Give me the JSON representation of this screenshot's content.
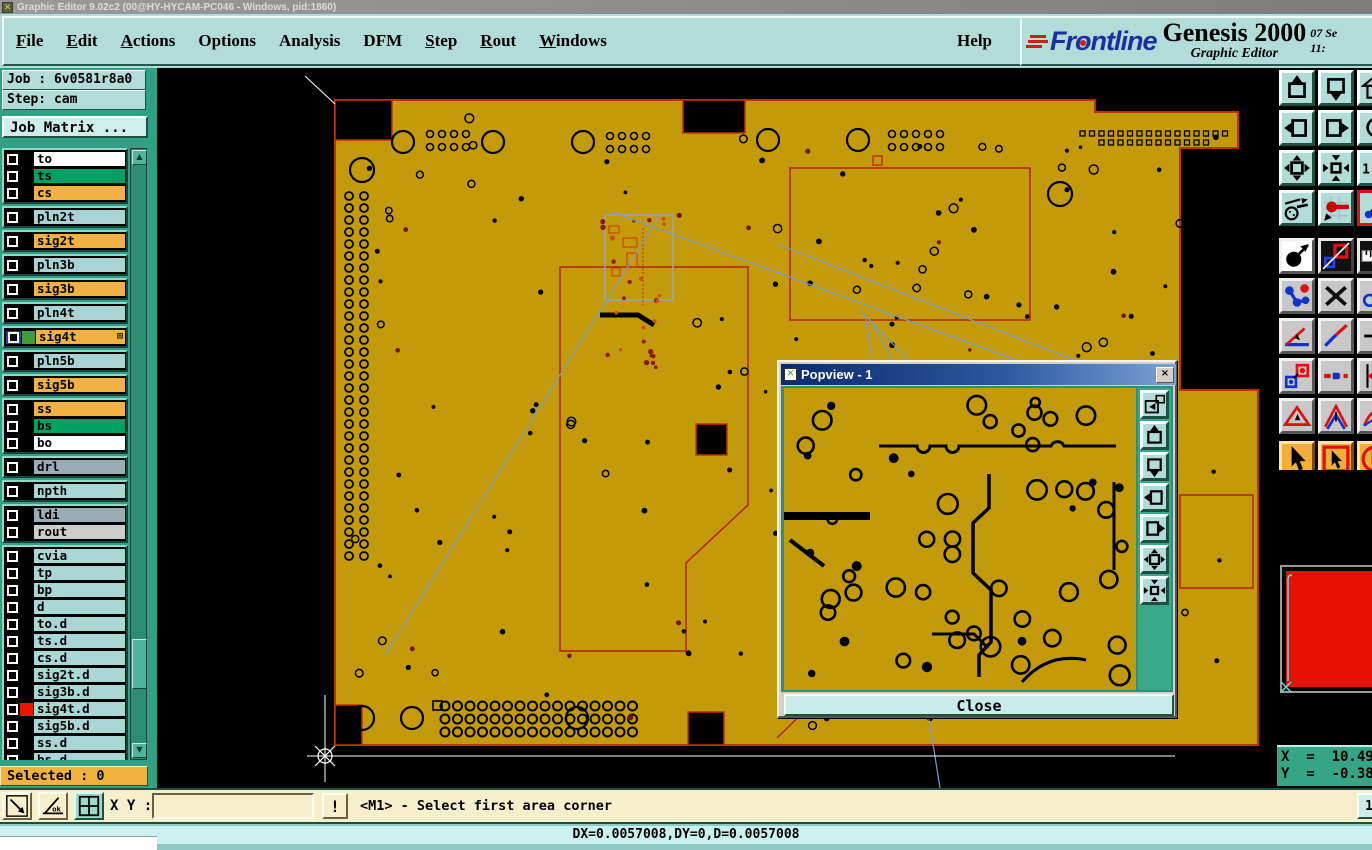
{
  "window": {
    "title": "Graphic Editor 9.02c2 (00@HY-HYCAM-PC046 - Windows, pid:1860)"
  },
  "menubar": {
    "items": [
      {
        "label": "File",
        "u": 0
      },
      {
        "label": "Edit",
        "u": 0
      },
      {
        "label": "Actions",
        "u": 0
      },
      {
        "label": "Options",
        "u": -1
      },
      {
        "label": "Analysis",
        "u": -1
      },
      {
        "label": "DFM",
        "u": -1
      },
      {
        "label": "Step",
        "u": 0
      },
      {
        "label": "Rout",
        "u": 0
      },
      {
        "label": "Windows",
        "u": 0
      }
    ],
    "help": {
      "label": "Help",
      "u": -1
    }
  },
  "brand": {
    "logo_text": "Frontline",
    "product": "Genesis 2000",
    "subtitle": "Graphic Editor",
    "date": "07 Se",
    "time": "11:"
  },
  "job_panel": {
    "job": "Job : 6v0581r8a0",
    "step": "Step: cam",
    "job_matrix": "Job Matrix ..."
  },
  "layers": {
    "selected_label": "Selected : 0",
    "items": [
      {
        "name": "to",
        "bg": "#ffffff",
        "swatch": "#000000",
        "g": 0
      },
      {
        "name": "ts",
        "bg": "#00a263",
        "swatch": "#000000",
        "g": 0
      },
      {
        "name": "cs",
        "bg": "#f2b23e",
        "swatch": "#000000",
        "g": 0
      },
      {
        "name": "pln2t",
        "bg": "#a9d3d3",
        "swatch": "#000000",
        "g": 1
      },
      {
        "name": "sig2t",
        "bg": "#f2b23e",
        "swatch": "#000000",
        "g": 2
      },
      {
        "name": "pln3b",
        "bg": "#a9d3d3",
        "swatch": "#000000",
        "g": 3
      },
      {
        "name": "sig3b",
        "bg": "#f2b23e",
        "swatch": "#000000",
        "g": 4
      },
      {
        "name": "pln4t",
        "bg": "#a9d3d3",
        "swatch": "#000000",
        "g": 5
      },
      {
        "name": "sig4t",
        "bg": "#f2b23e",
        "swatch": "#3f9e2f",
        "g": 6,
        "selected": true,
        "marker": "⊞"
      },
      {
        "name": "pln5b",
        "bg": "#a9d3d3",
        "swatch": "#000000",
        "g": 7
      },
      {
        "name": "sig5b",
        "bg": "#f2b23e",
        "swatch": "#000000",
        "g": 8
      },
      {
        "name": "ss",
        "bg": "#f2b23e",
        "swatch": "#000000",
        "g": 9
      },
      {
        "name": "bs",
        "bg": "#00a263",
        "swatch": "#000000",
        "g": 9
      },
      {
        "name": "bo",
        "bg": "#ffffff",
        "swatch": "#000000",
        "g": 9
      },
      {
        "name": "drl",
        "bg": "#9aacb6",
        "swatch": "#000000",
        "g": 10
      },
      {
        "name": "npth",
        "bg": "#a9d8d4",
        "swatch": "#000000",
        "g": 11
      },
      {
        "name": "ldi",
        "bg": "#9aacb6",
        "swatch": "#000000",
        "g": 12
      },
      {
        "name": "rout",
        "bg": "#cccccc",
        "swatch": "#000000",
        "g": 12
      },
      {
        "name": "cvia",
        "bg": "#a9d8d4",
        "swatch": "#000000",
        "g": 13
      },
      {
        "name": "tp",
        "bg": "#a9d8d4",
        "swatch": "#000000",
        "g": 13
      },
      {
        "name": "bp",
        "bg": "#a9d8d4",
        "swatch": "#000000",
        "g": 13
      },
      {
        "name": "d",
        "bg": "#a9d8d4",
        "swatch": "#000000",
        "g": 13
      },
      {
        "name": "to.d",
        "bg": "#a9d8d4",
        "swatch": "#000000",
        "g": 13
      },
      {
        "name": "ts.d",
        "bg": "#a9d8d4",
        "swatch": "#000000",
        "g": 13
      },
      {
        "name": "cs.d",
        "bg": "#a9d8d4",
        "swatch": "#000000",
        "g": 13
      },
      {
        "name": "sig2t.d",
        "bg": "#a9d8d4",
        "swatch": "#000000",
        "g": 13
      },
      {
        "name": "sig3b.d",
        "bg": "#a9d8d4",
        "swatch": "#000000",
        "g": 13
      },
      {
        "name": "sig4t.d",
        "bg": "#a9d8d4",
        "swatch": "#ee1500",
        "g": 13
      },
      {
        "name": "sig5b.d",
        "bg": "#a9d8d4",
        "swatch": "#000000",
        "g": 13
      },
      {
        "name": "ss.d",
        "bg": "#a9d8d4",
        "swatch": "#000000",
        "g": 13
      },
      {
        "name": "bs.d",
        "bg": "#a9d8d4",
        "swatch": "#000000",
        "g": 13
      },
      {
        "name": "bo.d",
        "bg": "#a9d8d4",
        "swatch": "#000000",
        "g": 13
      },
      {
        "name": "drl.d",
        "bg": "#a9d8d4",
        "swatch": "#000000",
        "g": 13
      },
      {
        "name": "npth.d",
        "bg": "#a9d8d4",
        "swatch": "#000000",
        "g": 13
      },
      {
        "name": "rout.d",
        "bg": "#a9d8d4",
        "swatch": "#000000",
        "g": 13
      }
    ]
  },
  "right_toolbar": {
    "rows": [
      [
        "view-pan-up",
        "view-pan-down",
        "view-home"
      ],
      [
        "view-pan-left",
        "view-pan-right",
        "view-rotate"
      ],
      [
        "zoom-out-view",
        "zoom-in-view",
        "zoom-one-to-one"
      ],
      [
        "setup-tools",
        "net-highlight",
        "netlist"
      ],
      [
        "pad-arrow",
        "layer-compare",
        "ruler"
      ],
      [
        "net-dots",
        "delete-x",
        "circle-arrow"
      ],
      [
        "angle-measure",
        "line-measure",
        "move-arrow"
      ],
      [
        "squares-copy",
        "dash-line",
        "align-edge"
      ],
      [
        "triangle-tool",
        "chevron-tool",
        "arc-tool"
      ],
      [
        "cursor-arrow",
        "cursor-box",
        "cursor-circle"
      ]
    ]
  },
  "popview": {
    "title": "Popview - 1",
    "close_x": "×",
    "close": "Close",
    "buttons": [
      "copy-view",
      "view-pan-up",
      "view-pan-down",
      "view-pan-left",
      "view-pan-right",
      "zoom-out-view",
      "zoom-in-view"
    ]
  },
  "coords": {
    "x": "X  =  10.4932",
    "y": "Y  =  -0.3807"
  },
  "command_bar": {
    "tools": [
      "resize-diag",
      "angle-ok",
      "grid-window"
    ],
    "xy_label": "X Y :",
    "input_value": "",
    "alert": "!",
    "message": "<M1> - Select first area corner",
    "side_button": "1"
  },
  "statusbar": {
    "text": "DX=0.0057008,DY=0,D=0.0057008"
  },
  "theme": {
    "board_gold": "#c39b0a",
    "board_outline_red": "#c23000",
    "highlight_blue": "#7b9cc9",
    "panel_teal": "#31a183",
    "ui_teal": "#b2dcd8",
    "selected_orange": "#f2b23e"
  }
}
